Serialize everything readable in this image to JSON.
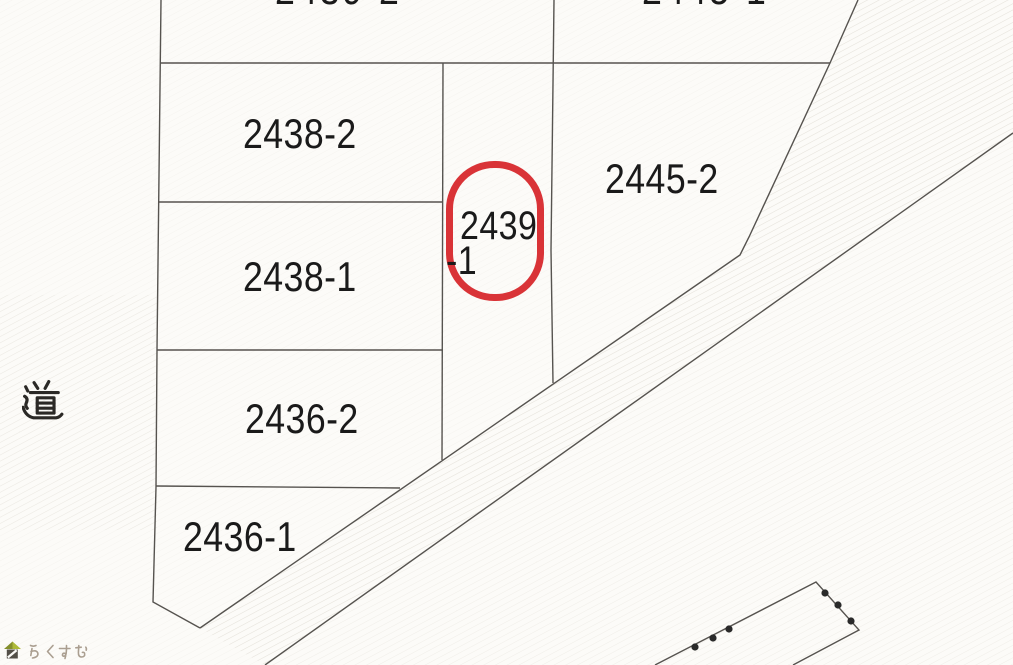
{
  "map": {
    "parcel_labels": {
      "top_left_clipped": "2439-2",
      "top_right_clipped": "2445-1",
      "b2438_2": "2438-2",
      "b2438_1": "2438-1",
      "b2436_2": "2436-2",
      "b2436_1": "2436-1",
      "b2445_2": "2445-2"
    },
    "highlighted_parcel": {
      "full_number": "2439-1",
      "number_line1": "2439",
      "number_line2": "-1",
      "ring_color": "#d62428"
    },
    "road_label": "道"
  },
  "watermark": {
    "text": "らくすむ",
    "icon": "house-icon",
    "text_color": "#a69a8b",
    "roof_color": "#aab72f",
    "body_color": "#4a463e"
  },
  "colors": {
    "background": "#fcfbf8",
    "boundary_line": "#56534f",
    "label_text": "#1a1a1a",
    "hatch": "#d6d1c7",
    "survey_dot": "#2a2a2a"
  }
}
